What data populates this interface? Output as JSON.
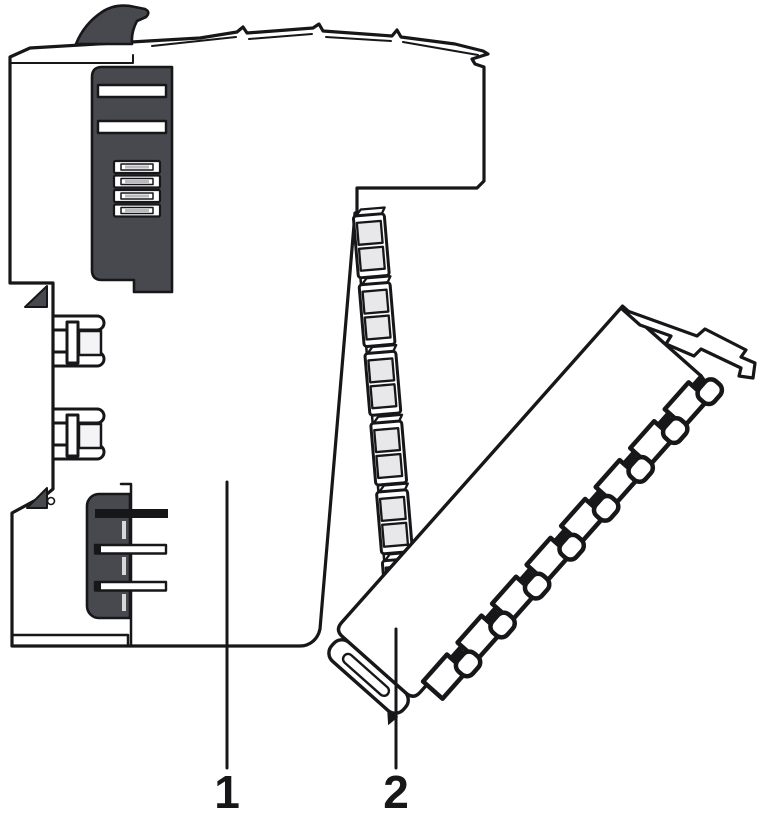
{
  "figure": {
    "type": "technical-illustration",
    "parts": [
      {
        "label": "1",
        "name": "electronics-module"
      },
      {
        "label": "2",
        "name": "pluggable-connector"
      }
    ],
    "colors": {
      "outline": "#17171a",
      "dark_gray": "#47494e",
      "contact_gray": "#e8e8ea",
      "plate_gray": "#f4f4f6",
      "background": "#ffffff"
    }
  }
}
